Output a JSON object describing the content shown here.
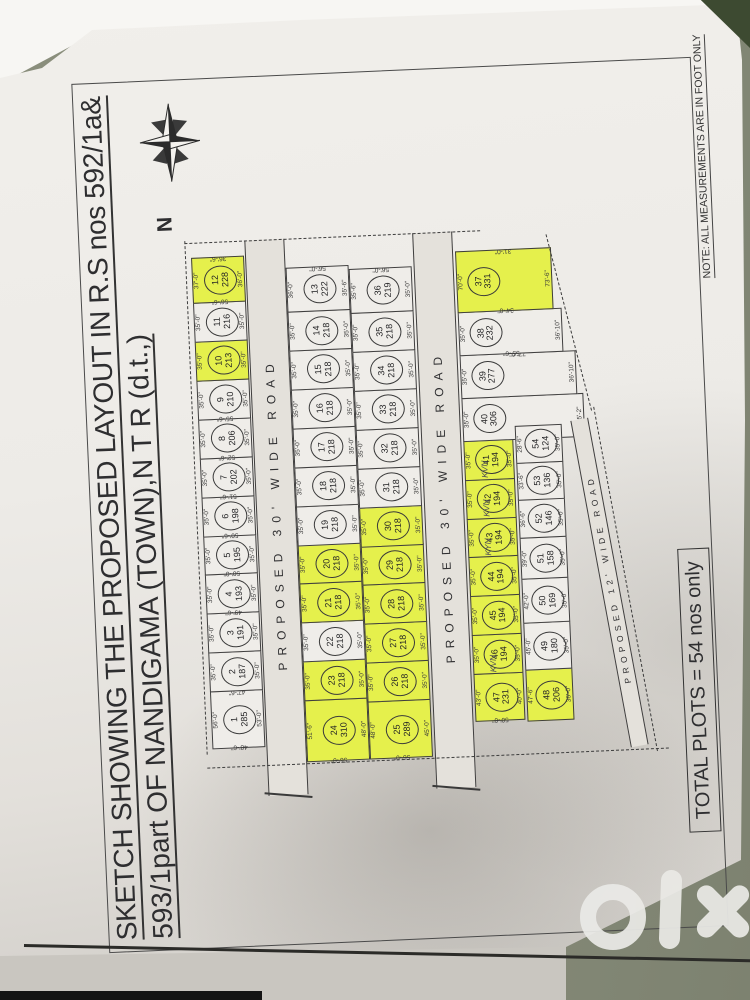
{
  "title": {
    "line1": "SKETCH SHOWING THE PROPOSED LAYOUT IN R.S nos 592/1a&",
    "line2": "593/1part OF NANDIGAMA (TOWN),N T R (d.t.,)"
  },
  "north_label": "N",
  "note": "NOTE: ALL MEASUREMENTS ARE IN FOOT ONLY",
  "total_plots": "TOTAL PLOTS =  54 nos only",
  "watermark": "olx",
  "colors": {
    "highlight": "#e5f04c",
    "paper": "#efede9",
    "road": "#e4e1db",
    "line": "#3f3e3e",
    "surface": "#868b79",
    "surface_dark": "#3d4a31"
  },
  "roads": [
    {
      "id": "road-30-a",
      "label": "PROPOSED 30' WIDE ROAD"
    },
    {
      "id": "road-30-b",
      "label": "PROPOSED 30' WIDE ROAD"
    },
    {
      "id": "road-12",
      "label": "PROPOSED 12' WIDE ROAD"
    }
  ],
  "default_dim": "35'-0\"",
  "bands": [
    {
      "id": "row-1-12",
      "type": "plots",
      "left": 200,
      "top": 112,
      "h": 53,
      "cells": [
        {
          "n": 1,
          "a": 285,
          "w": 58,
          "dt": "56'-0\"",
          "db": "53'-0\"",
          "dl": "48'-6\"",
          "dr": "47'-6\""
        },
        {
          "n": 2,
          "a": 187
        },
        {
          "n": 3,
          "a": 191
        },
        {
          "n": 4,
          "a": 193,
          "dl": "49'-6\""
        },
        {
          "n": 5,
          "a": 195,
          "dl": "50'-0\""
        },
        {
          "n": 6,
          "a": 198,
          "dl": "50'-6\""
        },
        {
          "n": 7,
          "a": 202,
          "dl": "51'-6\""
        },
        {
          "n": 8,
          "a": 206,
          "dl": "52'-6\""
        },
        {
          "n": 9,
          "a": 210,
          "dl": "55'-6\""
        },
        {
          "n": 10,
          "a": 213,
          "hl": true
        },
        {
          "n": 11,
          "a": 216
        },
        {
          "n": 12,
          "a": 228,
          "hl": true,
          "w": 46,
          "dt": "37'-0\"",
          "db": "36'-0\"",
          "dl": "56'-6\"",
          "dr": "36'-6\""
        }
      ]
    },
    {
      "id": "road-30-a",
      "type": "road",
      "left": 150,
      "top": 166,
      "w": 556,
      "h": 40,
      "label_index": 0
    },
    {
      "id": "row-24-13",
      "type": "plots",
      "left": 183,
      "top": 206,
      "h": 63,
      "cells": [
        {
          "n": 24,
          "a": 310,
          "hl": true,
          "w": 62,
          "dt": "51'-6\"",
          "db": "48'-0\"",
          "dl": "56'-0\""
        },
        {
          "n": 23,
          "a": 218,
          "hl": true
        },
        {
          "n": 22,
          "a": 218
        },
        {
          "n": 21,
          "a": 218,
          "hl": true
        },
        {
          "n": 20,
          "a": 218,
          "hl": true
        },
        {
          "n": 19,
          "a": 218
        },
        {
          "n": 18,
          "a": 218
        },
        {
          "n": 17,
          "a": 218
        },
        {
          "n": 16,
          "a": 218
        },
        {
          "n": 15,
          "a": 218
        },
        {
          "n": 14,
          "a": 218
        },
        {
          "n": 13,
          "a": 222,
          "w": 45,
          "dt": "36'-0\"",
          "db": "35'-6\"",
          "dr": "56'-0\""
        }
      ]
    },
    {
      "id": "row-25-36",
      "type": "plots",
      "left": 183,
      "top": 269,
      "h": 63,
      "cells": [
        {
          "n": 25,
          "a": 289,
          "hl": true,
          "w": 58,
          "dt": "48'-0\"",
          "db": "45'-0\"",
          "dl": "56'-0\""
        },
        {
          "n": 26,
          "a": 218,
          "hl": true
        },
        {
          "n": 27,
          "a": 218,
          "hl": true
        },
        {
          "n": 28,
          "a": 218,
          "hl": true
        },
        {
          "n": 29,
          "a": 218,
          "hl": true
        },
        {
          "n": 30,
          "a": 218,
          "hl": true
        },
        {
          "n": 31,
          "a": 218
        },
        {
          "n": 32,
          "a": 218
        },
        {
          "n": 33,
          "a": 218
        },
        {
          "n": 34,
          "a": 218
        },
        {
          "n": 35,
          "a": 218
        },
        {
          "n": 36,
          "a": 219,
          "w": 45,
          "dt": "35'-6\"",
          "dr": "56'-0\""
        }
      ]
    },
    {
      "id": "road-30-b",
      "type": "road",
      "left": 150,
      "top": 334,
      "w": 556,
      "h": 40,
      "label_index": 1
    },
    {
      "id": "row-47-37",
      "type": "plots",
      "left": 216,
      "top": 376,
      "h": 50,
      "cells": [
        {
          "n": 47,
          "a": 231,
          "hl": true,
          "w": 48,
          "dt": "43'-0\"",
          "db": "40'-0\"",
          "dl": "50'-0\""
        },
        {
          "n": 46,
          "a": 194,
          "hl": true,
          "kvn": "KVN"
        },
        {
          "n": 45,
          "a": 194,
          "hl": true
        },
        {
          "n": 44,
          "a": 194,
          "hl": true
        },
        {
          "n": 43,
          "a": 194,
          "hl": true,
          "kvn": "KYN"
        },
        {
          "n": 42,
          "a": 194,
          "hl": true,
          "kvn": "KVN"
        },
        {
          "n": 41,
          "a": 194,
          "hl": true,
          "kvn": "KVN"
        },
        {
          "n": 40,
          "a": 306,
          "h": 122,
          "w": 44,
          "dl": "60'-6\"",
          "db": "35'-2\""
        },
        {
          "n": 39,
          "a": 277,
          "h": 116,
          "w": 44,
          "dr": "77'-0\"",
          "db": "36'-10\""
        },
        {
          "n": 38,
          "a": 232,
          "h": 104,
          "w": 44,
          "dl": "55'-6\"",
          "db": "36'-10\""
        },
        {
          "n": 37,
          "a": 331,
          "hl": true,
          "w": 62,
          "h": 96,
          "dt": "70'-0\"",
          "db": "73'-6\"",
          "dl": "34'-0\"",
          "dr": "31'-0\""
        }
      ]
    },
    {
      "id": "row-48-54",
      "type": "plots",
      "left": 214,
      "top": 428,
      "h": 47,
      "cells": [
        {
          "n": 48,
          "a": 206,
          "hl": true,
          "w": 52,
          "dt": "47'-6\"",
          "db": "36'-0\""
        },
        {
          "n": 49,
          "a": 180,
          "w": 48,
          "dt": "45'-0\""
        },
        {
          "n": 50,
          "a": 169,
          "w": 45,
          "dt": "42'-0\""
        },
        {
          "n": 51,
          "a": 158,
          "w": 42,
          "dt": "39'-0\""
        },
        {
          "n": 52,
          "a": 146,
          "w": 40,
          "dt": "36'-6\""
        },
        {
          "n": 53,
          "a": 136,
          "w": 38,
          "dt": "33'-6\""
        },
        {
          "n": 54,
          "a": 124,
          "w": 38,
          "dt": "28'-6\""
        }
      ]
    }
  ]
}
